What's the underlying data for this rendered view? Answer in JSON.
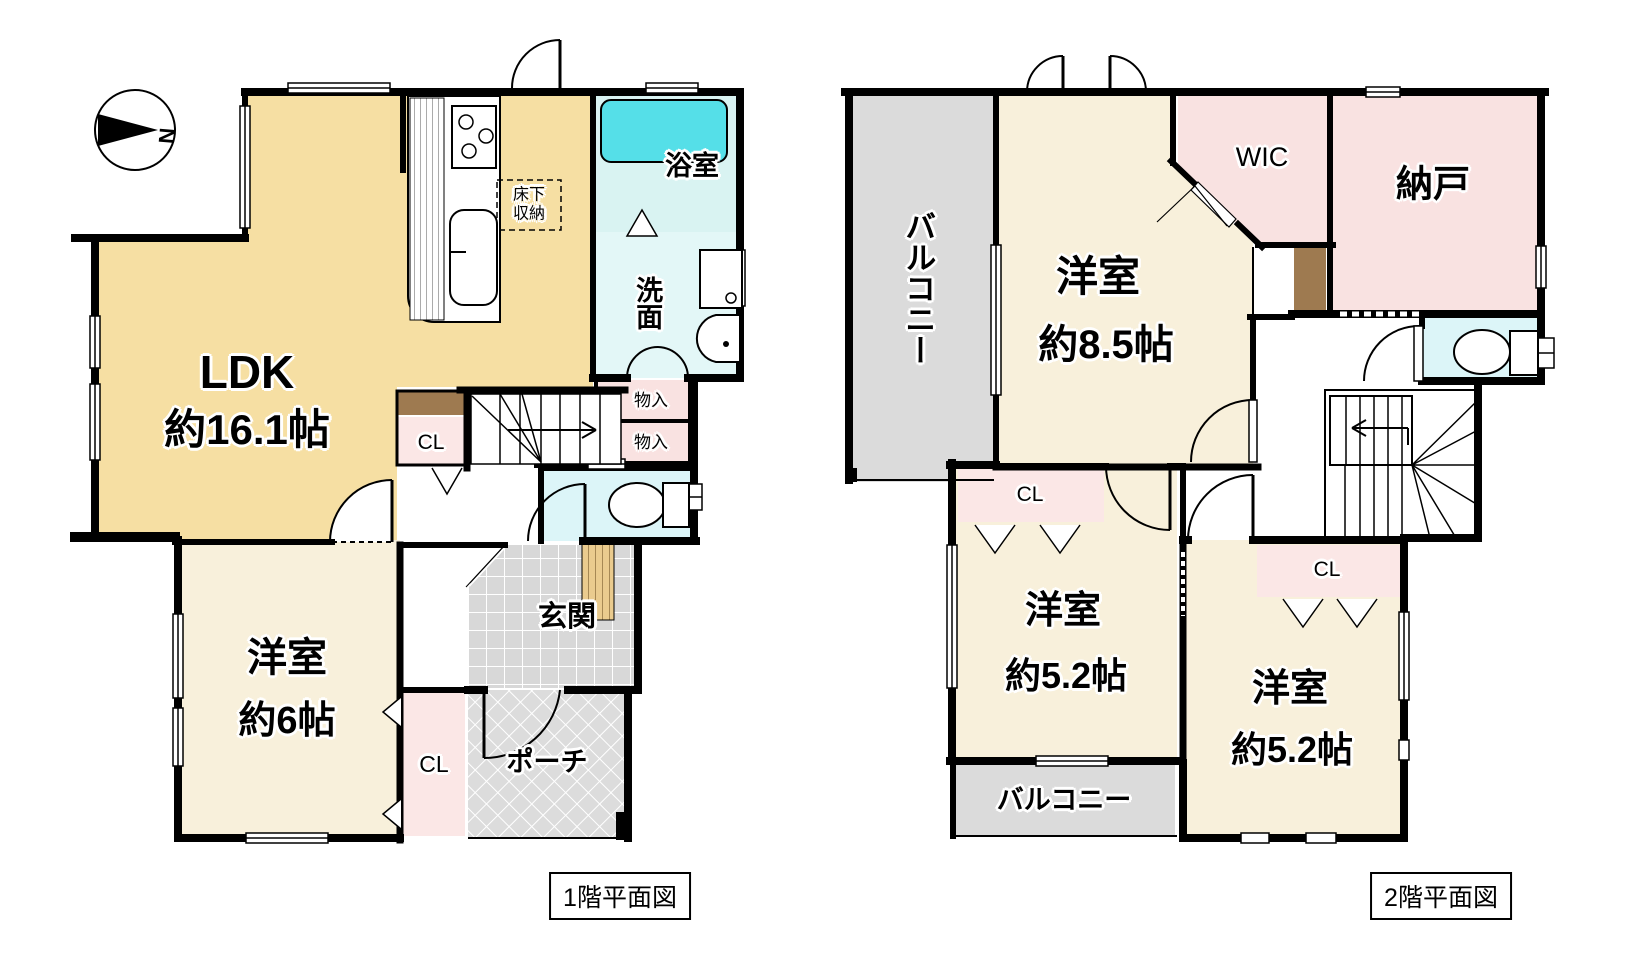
{
  "compass": {
    "north": "N"
  },
  "colors": {
    "ldk_beige": "#F6DFA3",
    "room_cream": "#F8F0DB",
    "closet_pink": "#FBE7E6",
    "storage_pink": "#F9E2E1",
    "bath_cyan": "#D9F3F2",
    "wash_cyan": "#E3F7F7",
    "toilet_cyan": "#DCF5F8",
    "tub_cyan": "#55DFE8",
    "balcony_gray": "#DBDBDB",
    "wood_brown": "#9E7A50",
    "step_tan": "#EACB8E",
    "wall_black": "#000000"
  },
  "floor1": {
    "caption": "1階平面図",
    "rooms": {
      "ldk_line1": "LDK",
      "ldk_line2": "約16.1帖",
      "underfloor_line1": "床下",
      "underfloor_line2": "収納",
      "bath": "浴室",
      "wash": "洗面",
      "storage1": "物入",
      "storage2": "物入",
      "closet_hall": "CL",
      "entrance": "玄関",
      "western6_line1": "洋室",
      "western6_line2": "約6帖",
      "closet_south": "CL",
      "porch": "ポーチ"
    }
  },
  "floor2": {
    "caption": "2階平面図",
    "rooms": {
      "balcony_west": "バルコニー",
      "western85_line1": "洋室",
      "western85_line2": "約8.5帖",
      "wic": "WIC",
      "storeroom": "納戸",
      "closet_west": "CL",
      "western52w_line1": "洋室",
      "western52w_line2": "約5.2帖",
      "closet_east": "CL",
      "western52e_line1": "洋室",
      "western52e_line2": "約5.2帖",
      "balcony_south": "バルコニー"
    }
  }
}
